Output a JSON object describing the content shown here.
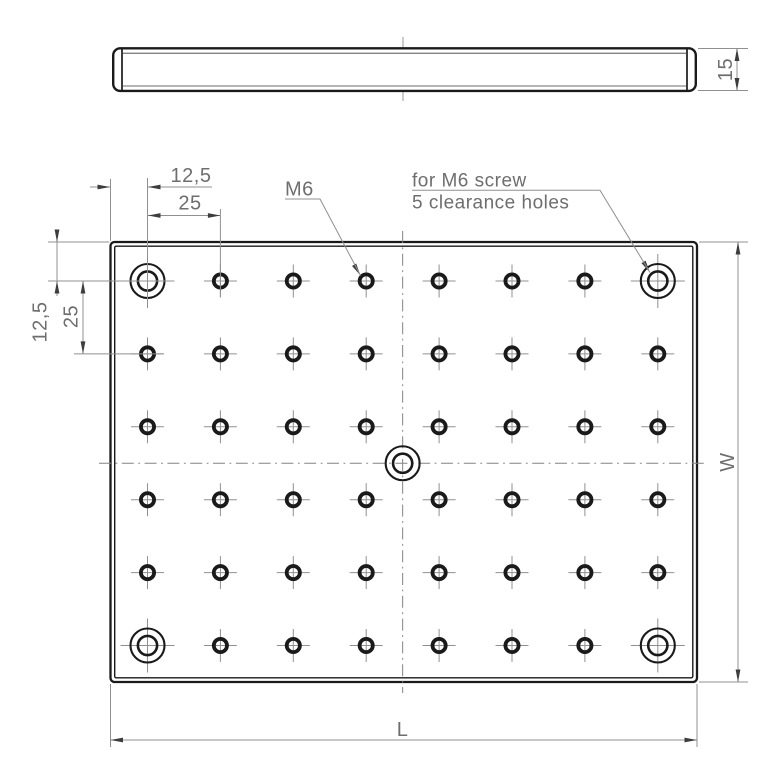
{
  "side_view": {
    "thickness_dim": "15"
  },
  "plan_view": {
    "dim_margin_top": "12,5",
    "dim_pitch_top": "25",
    "dim_margin_left": "12,5",
    "dim_pitch_left": "25",
    "thread_label": "M6",
    "note_line1": "for M6 screw",
    "note_line2": "5 clearance holes",
    "width_label": "W",
    "length_label": "L",
    "grid": {
      "columns": 8,
      "rows": 6
    },
    "clearance_hole_count": 5
  },
  "colors": {
    "outline": "#1a1a1a",
    "thin_line": "#909090",
    "centerline": "#848484",
    "arrow": "#3d3d3d",
    "text": "#6e6e6e",
    "background": "#ffffff"
  }
}
